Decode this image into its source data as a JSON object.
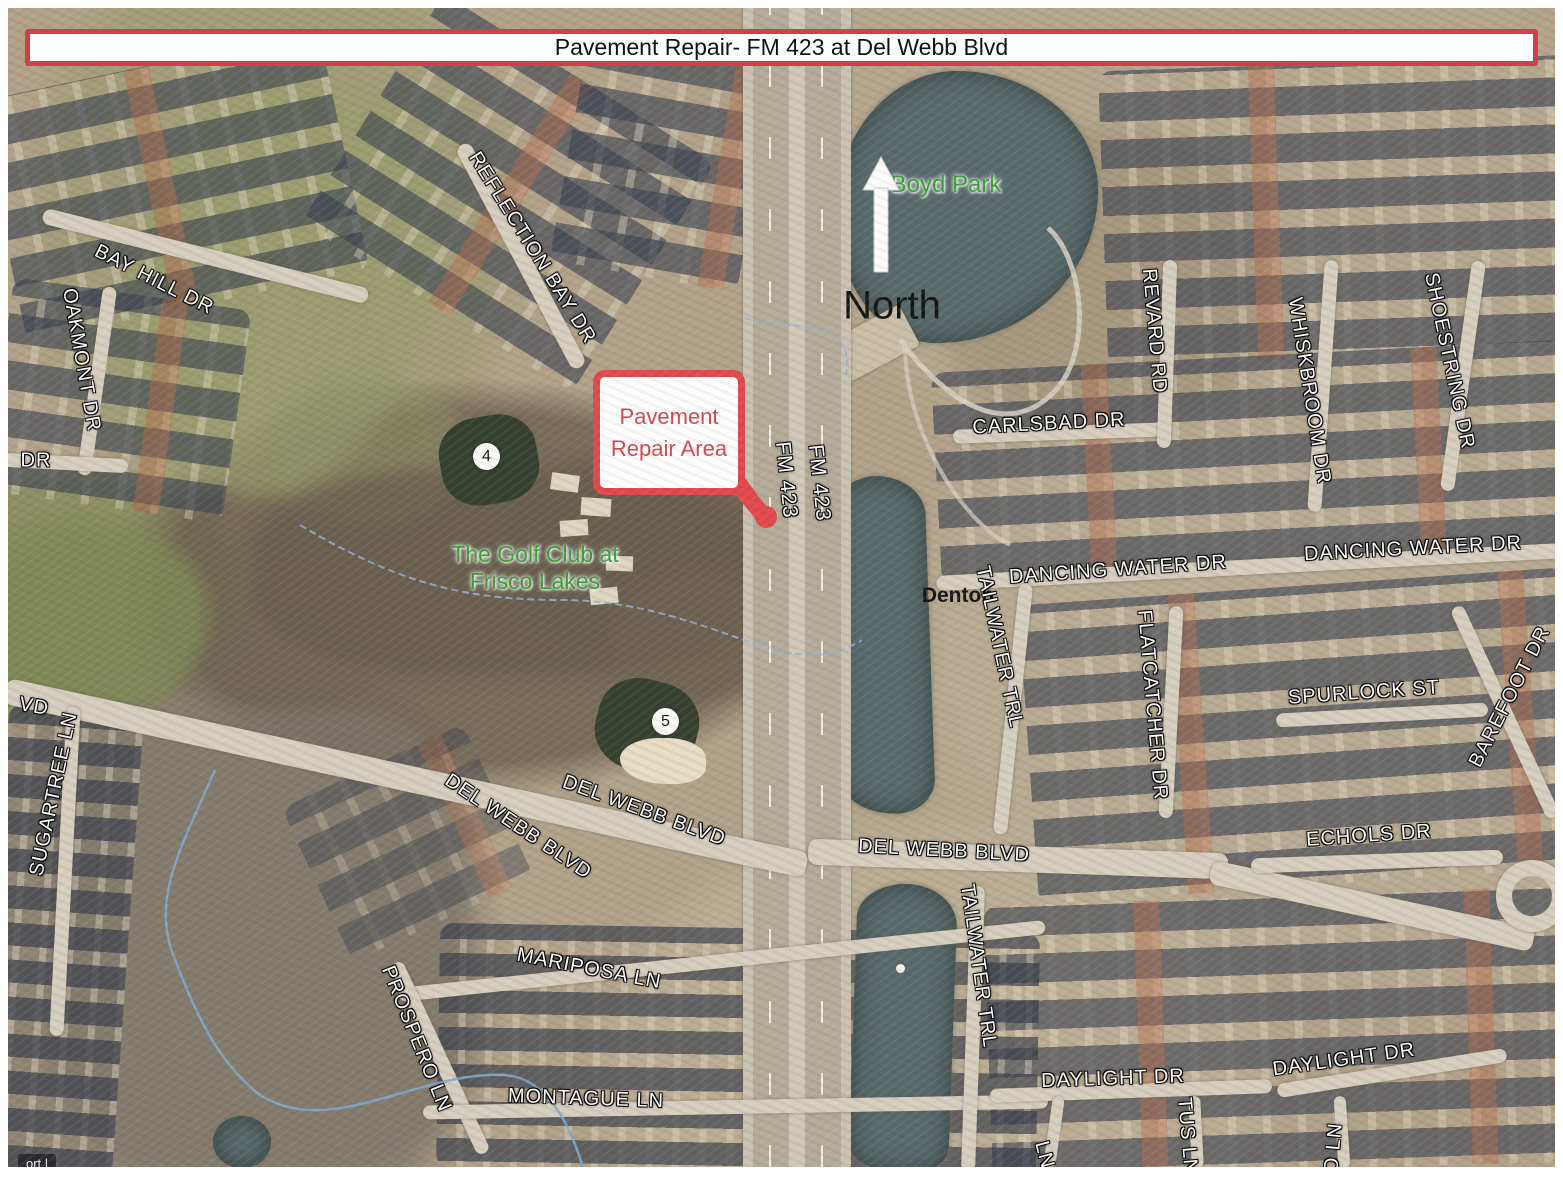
{
  "title": "Pavement Repair- FM 423 at Del Webb Blvd",
  "annotations": {
    "north": "North",
    "callout": {
      "line1": "Pavement",
      "line2": "Repair Area"
    }
  },
  "map": {
    "parks": {
      "boyd": "Boyd Park",
      "golf_line1": "The Golf Club at",
      "golf_line2": "Frisco Lakes"
    },
    "county_label": "Denton",
    "golf_holes": {
      "hole4": "4",
      "hole5": "5"
    },
    "street_labels": [
      {
        "text": "BAY HILL DR"
      },
      {
        "text": "OAKMONT DR"
      },
      {
        "text": "DR"
      },
      {
        "text": "REFLECTION BAY DR"
      },
      {
        "text": "VD"
      },
      {
        "text": "SUGARTREE LN"
      },
      {
        "text": "DEL WEBB BLVD"
      },
      {
        "text": "DEL WEBB BLVD"
      },
      {
        "text": "DEL WEBB BLVD"
      },
      {
        "text": "MARIPOSA LN"
      },
      {
        "text": "PROSPERO LN"
      },
      {
        "text": "MONTAGUE LN"
      },
      {
        "text": "FM 423"
      },
      {
        "text": "FM 423"
      },
      {
        "text": "CARLSBAD DR"
      },
      {
        "text": "REVARD RD"
      },
      {
        "text": "WHISKBROOM DR"
      },
      {
        "text": "SHOESTRING DR"
      },
      {
        "text": "DANCING WATER DR"
      },
      {
        "text": "DANCING WATER DR"
      },
      {
        "text": "TAILWATER TRL"
      },
      {
        "text": "FLATCATCHER DR"
      },
      {
        "text": "SPURLOCK ST"
      },
      {
        "text": "BAREFOOT DR"
      },
      {
        "text": "ECHOLS DR"
      },
      {
        "text": "TAILWATER TRL"
      },
      {
        "text": "DAYLIGHT DR"
      },
      {
        "text": "DAYLIGHT DR"
      },
      {
        "text": "LN"
      },
      {
        "text": "TUS LN"
      },
      {
        "text": "O LN"
      }
    ]
  },
  "attribution": "ort |",
  "colors": {
    "callout_red": "#e2484d",
    "title_border_red": "#c9444a",
    "park_green": "#3c9e3a",
    "water": "#57696a",
    "road": "#d6cfbf"
  }
}
